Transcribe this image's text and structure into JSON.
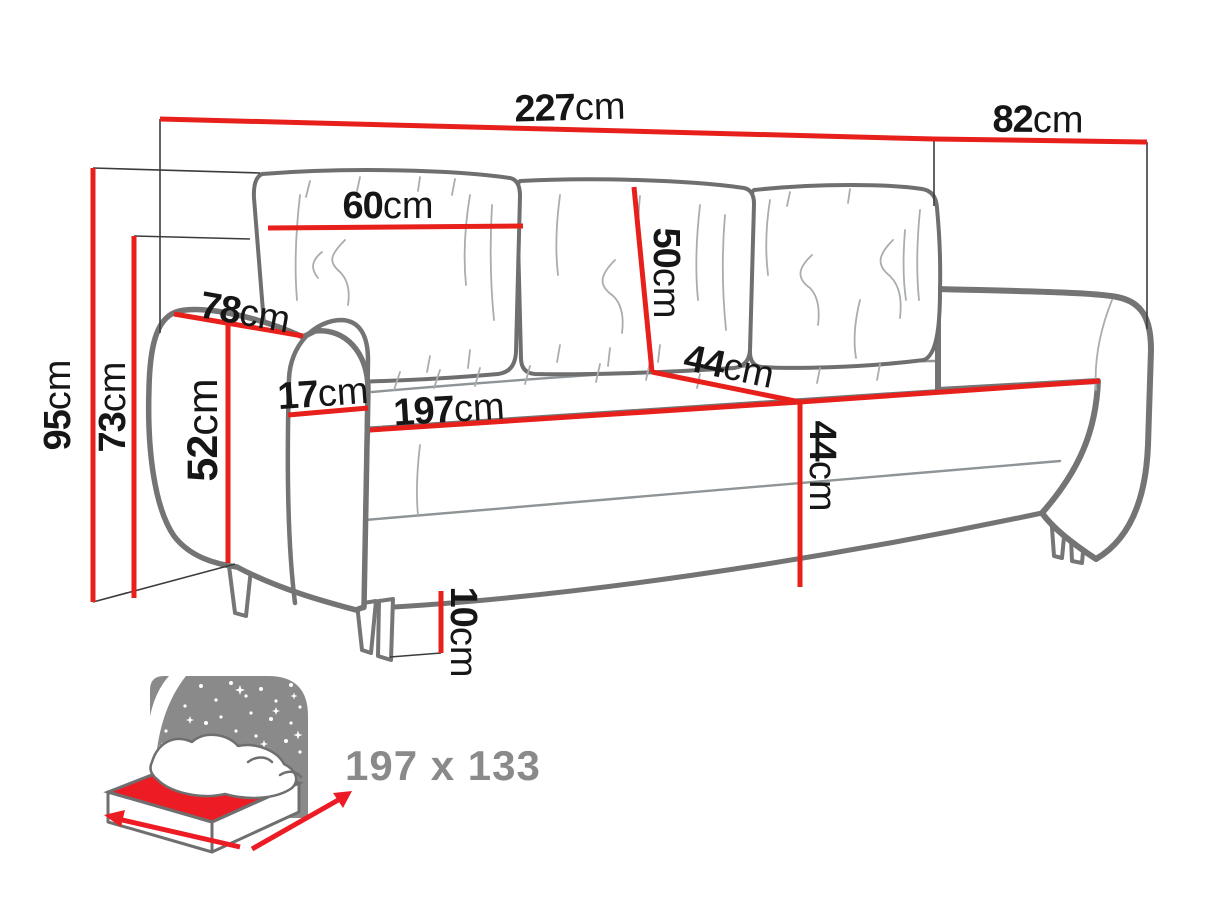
{
  "diagram": {
    "title": "sofa-bed dimension diagram",
    "colors": {
      "dimension_red": "#e7201b",
      "outline_gray": "#747474",
      "label_black": "#161616",
      "icon_gray": "#8a8a8a"
    },
    "dimensions": [
      {
        "id": "total-width",
        "value": "227",
        "unit": "cm"
      },
      {
        "id": "total-depth",
        "value": "82",
        "unit": "cm"
      },
      {
        "id": "back-cushion-width",
        "value": "60",
        "unit": "cm"
      },
      {
        "id": "armrest-depth",
        "value": "78",
        "unit": "cm"
      },
      {
        "id": "total-height",
        "value": "95",
        "unit": "cm"
      },
      {
        "id": "backrest-height",
        "value": "73",
        "unit": "cm"
      },
      {
        "id": "armrest-height",
        "value": "52",
        "unit": "cm"
      },
      {
        "id": "armrest-width",
        "value": "17",
        "unit": "cm"
      },
      {
        "id": "seat-width",
        "value": "197",
        "unit": "cm"
      },
      {
        "id": "back-cushion-height",
        "value": "50",
        "unit": "cm"
      },
      {
        "id": "seat-depth",
        "value": "44",
        "unit": "cm"
      },
      {
        "id": "seat-height",
        "value": "44",
        "unit": "cm"
      },
      {
        "id": "leg-height",
        "value": "10",
        "unit": "cm"
      }
    ],
    "sleeping_area": {
      "label": "197 x 133"
    }
  }
}
